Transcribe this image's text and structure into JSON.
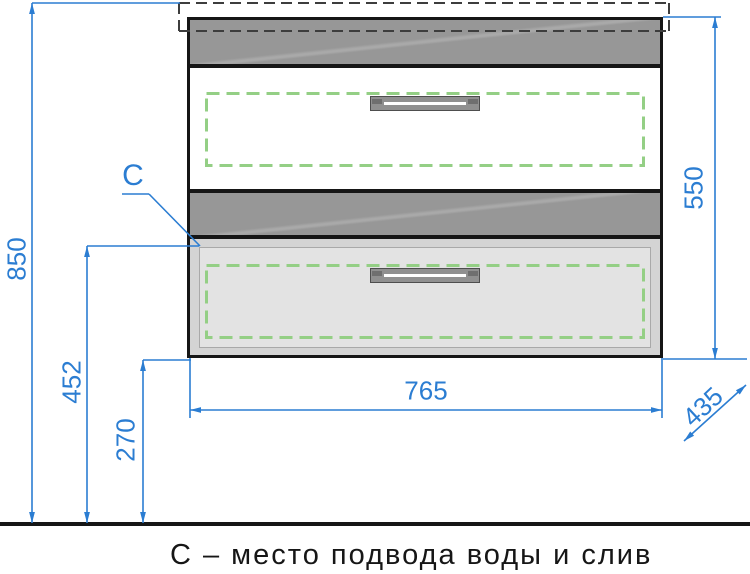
{
  "drawing": {
    "caption": "С – место подвода воды и слив",
    "connection_label": "С",
    "dimensions": {
      "overall_height": "850",
      "connection_height": "452",
      "floor_clearance": "270",
      "cabinet_height": "550",
      "cabinet_width": "765",
      "cabinet_depth": "435"
    },
    "colors": {
      "dimension_blue": "#2b7dd2",
      "outline_black": "#161616",
      "panel_gray": "#9a9a9a",
      "drawer_panel_gray": "#e3e3e3",
      "clearance_green": "#94cf85",
      "handle_gray": "#909090"
    }
  }
}
